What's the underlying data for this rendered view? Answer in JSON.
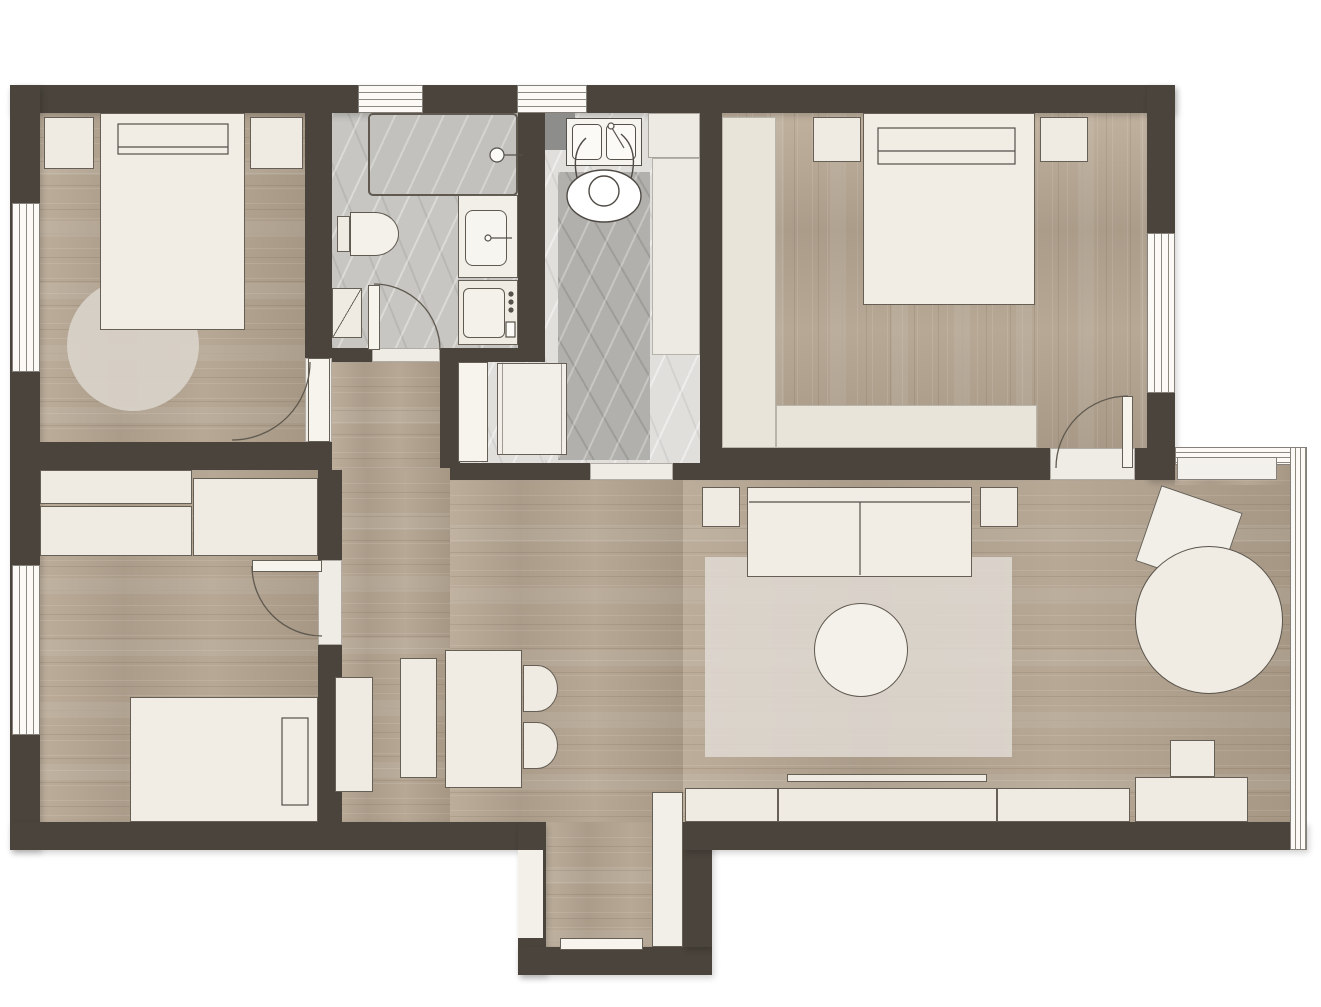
{
  "document": {
    "type": "floor-plan",
    "description": "Top-down architectural floor plan of an apartment with two large bedrooms, one small bedroom, bathroom, kitchen, open living-dining area and entry vestibule",
    "visible_text": "none"
  },
  "colors": {
    "wall": "#4a443c",
    "outline": "#655f56",
    "furniture": "#efebe2",
    "wood": "#b3a492",
    "marble": "#c7c6c2",
    "marble_dark": "#b1b0ac",
    "rug": "#dcd7d0",
    "glass": "#fbfaf7"
  },
  "rooms": [
    {
      "name": "bedroom-1",
      "label": "Bedroom (top left)",
      "floor": "wood"
    },
    {
      "name": "bathroom",
      "label": "Bathroom",
      "floor": "stone"
    },
    {
      "name": "kitchen",
      "label": "Kitchen / utility room",
      "floor": "stone"
    },
    {
      "name": "bedroom-2",
      "label": "Bedroom (top right)",
      "floor": "wood"
    },
    {
      "name": "bedroom-3",
      "label": "Bedroom (bottom left)",
      "floor": "wood"
    },
    {
      "name": "living-dining",
      "label": "Living / dining area",
      "floor": "wood"
    },
    {
      "name": "entry",
      "label": "Entry vestibule",
      "floor": "wood"
    },
    {
      "name": "hallway",
      "label": "Hallway",
      "floor": "wood"
    }
  ],
  "labels": {
    "wall": "wall",
    "window": "window",
    "glass_wall": "floor-to-ceiling window",
    "window_sill": "window sill",
    "threshold": "doorway threshold",
    "door": "door leaf",
    "door_swing": "door swing",
    "entry_door": "entrance door",
    "bed_double": "double bed",
    "bed_single": "single bed",
    "pillow": "pillow",
    "headboard": "headboard",
    "nightstand": "nightstand",
    "rug_round": "round rug",
    "rug_area": "area rug",
    "wardrobe": "wardrobe",
    "closet": "built-in closet",
    "bathtub": "bathtub",
    "faucet": "faucet",
    "toilet": "toilet",
    "vanity": "washbasin vanity",
    "washing_machine": "washing machine",
    "corner_shelf": "corner unit",
    "stove": "cooktop",
    "kitchen_sink": "double kitchen sink",
    "person": "person standing at sink",
    "counter": "kitchen counter",
    "tall_cabinet": "tall cabinet / refrigerator",
    "runner": "stone runner",
    "dining_table": "dining table",
    "dining_chair": "dining chair",
    "dining_bench": "dining bench",
    "sideboard": "sideboard",
    "sofa": "two-seat sofa",
    "side_table": "side table",
    "coffee_table": "round coffee table",
    "round_table": "round table",
    "lounge_chair": "chair",
    "tv": "television",
    "media_console": "media console",
    "desk": "desk",
    "desk_chair": "desk chair"
  }
}
